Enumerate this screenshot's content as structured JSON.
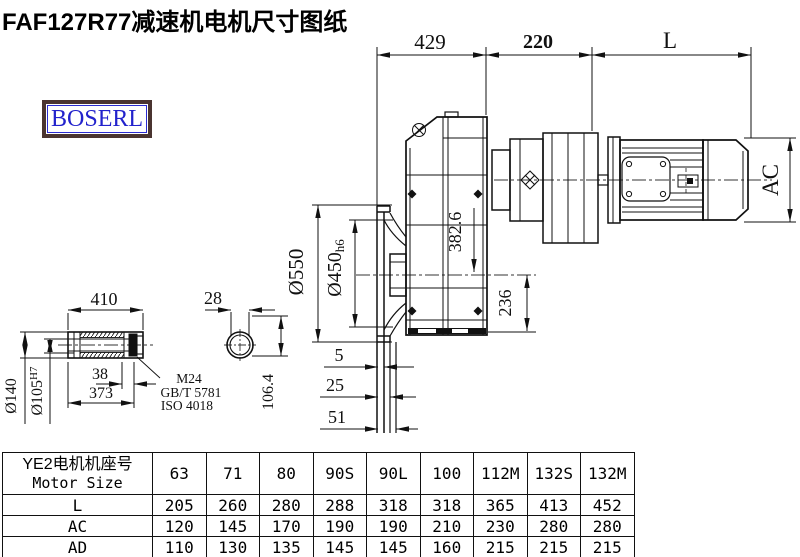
{
  "title": "FAF127R77减速机电机尺寸图纸",
  "logo_text": "BOSERL",
  "drawing": {
    "dims": {
      "top_429": "429",
      "top_220": "220",
      "top_L": "L",
      "ac": "AC",
      "flange_od": "Ø550",
      "spigot_od": "Ø450",
      "spigot_tol": "h6",
      "axis_drop": "382.6",
      "base_h": "236",
      "shaft_len": "410",
      "key_w": "28",
      "shaft_od": "Ø140",
      "bore": "Ø105",
      "bore_tol": "H7",
      "d38": "38",
      "d373": "373",
      "thread": "M24",
      "std_gb": "GB/T 5781",
      "std_iso": "ISO 4018",
      "d106": "106.4",
      "g5": "5",
      "g25": "25",
      "g51": "51"
    }
  },
  "table": {
    "header_cn": "YE2电机机座号",
    "header_en": "Motor Size",
    "columns": [
      "63",
      "71",
      "80",
      "90S",
      "90L",
      "100",
      "112M",
      "132S",
      "132M"
    ],
    "rows": [
      {
        "label": "L",
        "values": [
          "205",
          "260",
          "280",
          "288",
          "318",
          "318",
          "365",
          "413",
          "452"
        ]
      },
      {
        "label": "AC",
        "values": [
          "120",
          "145",
          "170",
          "190",
          "190",
          "210",
          "230",
          "280",
          "280"
        ]
      },
      {
        "label": "AD",
        "values": [
          "110",
          "130",
          "135",
          "145",
          "145",
          "160",
          "215",
          "215",
          "215"
        ]
      }
    ]
  }
}
